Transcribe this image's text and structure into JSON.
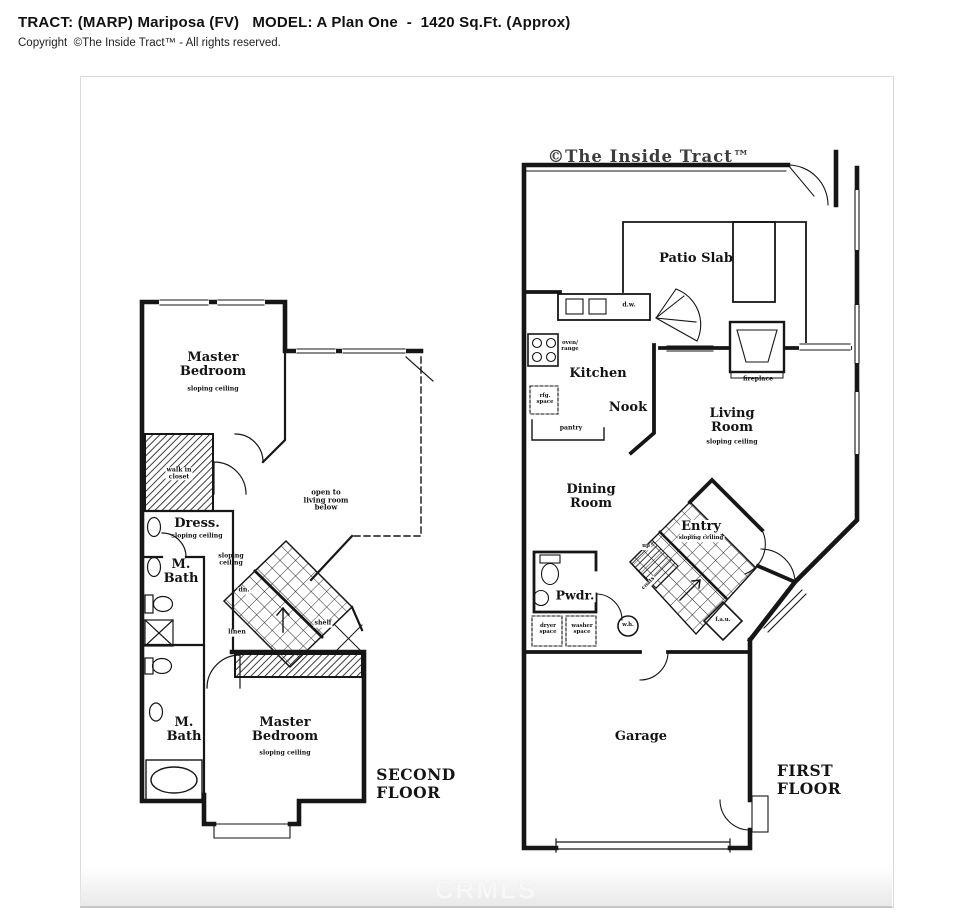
{
  "header": {
    "title": "TRACT: (MARP) Mariposa (FV)   MODEL: A Plan One  -  1420 Sq.Ft. (Approx)",
    "copyright": "Copyright  ©The Inside Tract™ - All rights reserved."
  },
  "plan": {
    "watermark_top": "©The Inside Tract™",
    "watermark_bottom": "CRMLS",
    "colors": {
      "wall": "#161616",
      "border": "#d9d9d9"
    },
    "second_floor": {
      "floor_label": "SECOND\nFLOOR",
      "labels": {
        "master_bedroom_upper": "Master\nBedroom",
        "master_bedroom_upper_sub": "sloping ceiling",
        "walk_in_closet": "walk in\ncloset",
        "dress": "Dress.",
        "dress_sub": "sloping ceiling",
        "m_bath_upper": "M.\nBath",
        "hall_sloping": "sloping\nceiling",
        "dn": "dn.",
        "linen": "linen",
        "open_to_below": "open to\nliving room\nbelow",
        "shelf": "shelf",
        "master_bedroom_lower": "Master\nBedroom",
        "master_bedroom_lower_sub": "sloping ceiling",
        "m_bath_lower": "M.\nBath"
      }
    },
    "first_floor": {
      "floor_label": "FIRST\nFLOOR",
      "labels": {
        "patio_slab": "Patio Slab",
        "kitchen": "Kitchen",
        "nook": "Nook",
        "oven_range": "oven/\nrange",
        "rfg_space": "rfg.\nspace",
        "pantry": "pantry",
        "dw": "d.w.",
        "dining_room": "Dining\nRoom",
        "living_room": "Living\nRoom",
        "living_room_sub": "sloping ceiling",
        "fireplace": "fireplace",
        "entry": "Entry",
        "entry_sub": "sloping ceiling",
        "pwdr": "Pwdr.",
        "up": "up",
        "coats": "coats",
        "wh": "w.h.",
        "fau": "f.a.u.",
        "dryer_space": "dryer\nspace",
        "washer_space": "washer\nspace",
        "garage": "Garage"
      }
    }
  }
}
